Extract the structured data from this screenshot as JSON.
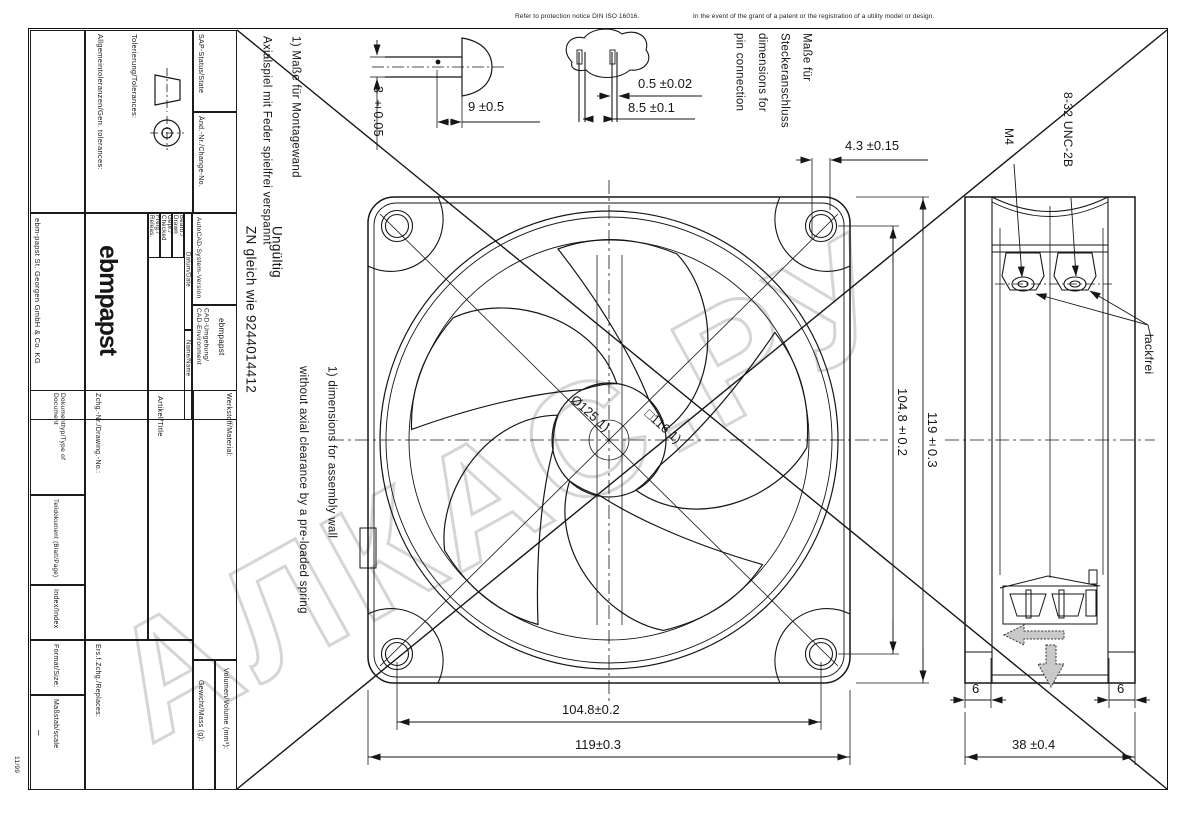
{
  "sheet": {
    "notice_left": "Refer to protection notice DIN ISO 16016.",
    "notice_right": "In the event of the grant of a patent or the registration of a utility model or design.",
    "form_code": "11/99",
    "watermark": "АЛКАС.РУ"
  },
  "title_block": {
    "tolerances_label": "Tolerierung/Tolerances:",
    "gen_tolerances_label": "Allgemeintoleranzen/Gen. tolerances:",
    "sap_status_label": "SAP-Status/State",
    "change_no_label": "Änd.-Nr./Change-No.",
    "company": "ebm-papst St. Georgen GmbH & Co. KG",
    "logo": "ebmpapst",
    "drawn_label": "Bearb./\nDrawn",
    "checked_label": "Gepr./\nChecked",
    "released_label": "Freig./\nReleas.",
    "date_label": "Datum/Date",
    "name_label": "Name/Name",
    "cad_version_label": "AutoCAD-System-Version",
    "cad_env_label": "CAD-Umgebung/\nCAD-Environment",
    "cad_env_value": "ebmpapst",
    "material_label": "Werkstoff/Material:",
    "article_label": "Artikel/Title",
    "drawing_no_label": "Zchg.-Nr./Drawing.-No.:",
    "doc_type_label": "Dokumenttyp/Type of Document",
    "part_doc_label": "Teildokument (Blatt/Page)",
    "index_label": "Index/Index",
    "format_label": "Format/Size:",
    "scale_label": "Maßstab/scale",
    "scale_value": "–",
    "replaces_label": "Ers.f.Zchg./Replaces:",
    "mass_label": "Gewicht/Mass (g):",
    "volume_label": "Volumen/Volume (mm³):"
  },
  "notes": {
    "mount_de": "1) Maße für Montagewand\nAxialspiel mit Feder spielfrei verspannt",
    "invalid": "Ungültig\nZN gleich wie 9244014412",
    "mount_en": "1) dimensions for assembly wall\nwithout axial clearance by a pre-loaded spring",
    "connector": "Maße für\nSteckeranschluss\ndimensions for\npin connection"
  },
  "dims": {
    "screw_dia": "3 ±0.05",
    "screw_len": "9 ±0.5",
    "pin_thk": "0.5 ±0.02",
    "pin_space": "8.5 ±0.1",
    "pin_offset": "4.3 ±0.15",
    "hole_pitch_v": "104.8±0.2",
    "size_v": "119±0.3",
    "hole_pitch_h": "104.8±0.2",
    "size_h": "119±0.3",
    "depth": "38 ±0.4",
    "flange_left": "6",
    "flange_right": "6",
    "impeller_dia": "Ø125 1)",
    "square_size": "□116 1)",
    "thread_m4": "M4",
    "thread_unc": "8-32 UNC-2B",
    "paint_free": "lackfrei"
  }
}
